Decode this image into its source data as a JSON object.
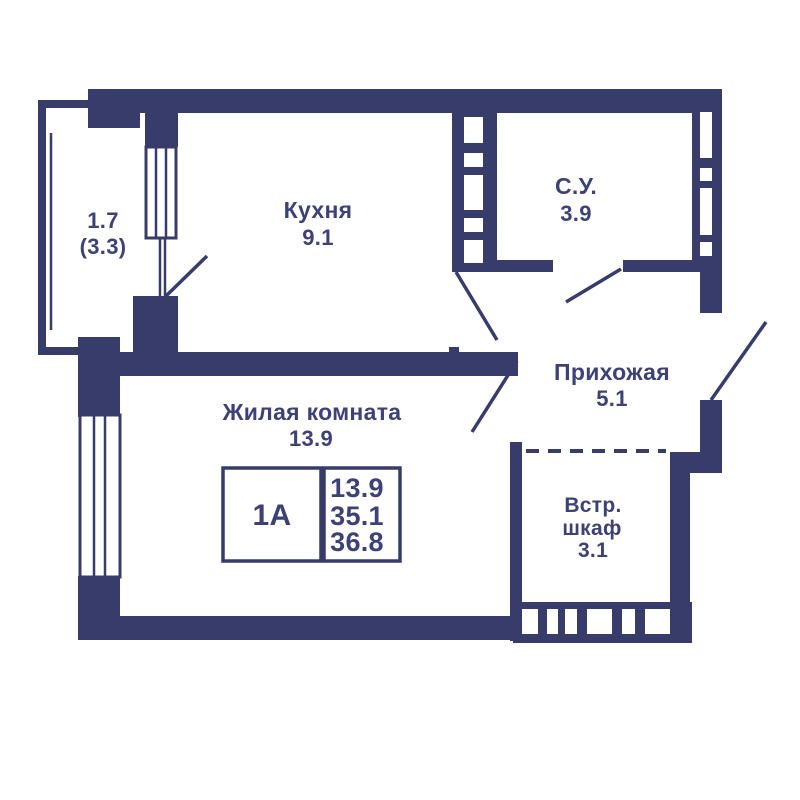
{
  "plan": {
    "unit_info": {
      "unit": "1А",
      "values": [
        "13.9",
        "35.1",
        "36.8"
      ]
    },
    "rooms": {
      "balcony": {
        "area": "1.7",
        "area_total": "(3.3)"
      },
      "kitchen": {
        "name": "Кухня",
        "area": "9.1"
      },
      "bathroom": {
        "name": "С.У.",
        "area": "3.9"
      },
      "hallway": {
        "name": "Прихожая",
        "area": "5.1"
      },
      "living_room": {
        "name": "Жилая комната",
        "area": "13.9"
      },
      "closet": {
        "name_line1": "Встр.",
        "name_line2": "шкаф",
        "area": "3.1"
      }
    },
    "colors": {
      "wall": "#373c6b",
      "text": "#3d4175",
      "background": "#ffffff"
    }
  }
}
